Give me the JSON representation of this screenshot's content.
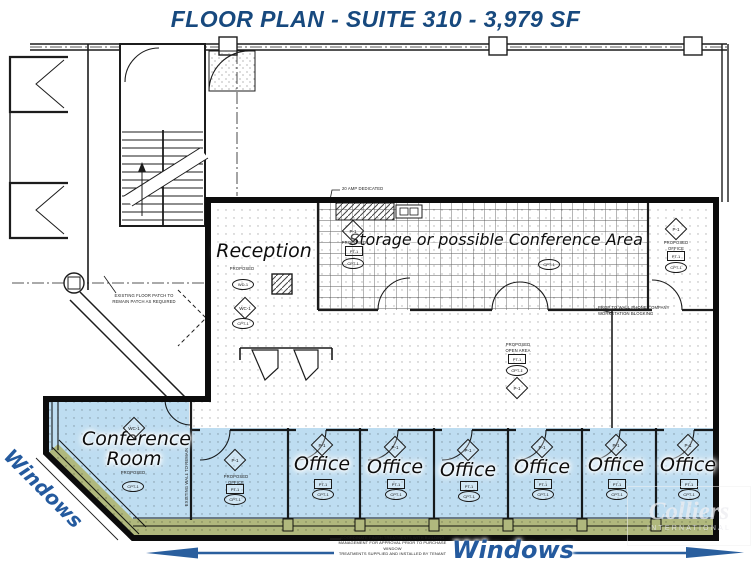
{
  "title": "FLOOR PLAN - SUITE 310 - 3,979 SF",
  "rooms": {
    "reception": "Reception",
    "storage": "Storage or possible Conference Area",
    "conference": "Conference Room",
    "offices": [
      "Office",
      "Office",
      "Office",
      "Office",
      "Office",
      "Office"
    ]
  },
  "window_labels": {
    "left": "Windows",
    "bottom": "Windows"
  },
  "tags": {
    "p1": "P-1",
    "wc1": "WC-1",
    "cpt1": "CPT-1",
    "pt1": "PT-1",
    "wd1": "WD-1"
  },
  "notes": {
    "dedicated": "20 AMP DEDICATED",
    "floor_patch": "EXISTING FLOOR PATCH TO\nREMAIN PATCH AS REQUIRED",
    "phone": "PROP TO WALL PHONE COMPANY\nWORKSTATION BLOCKING",
    "open_area": "PROPOSED\nOPEN AREA",
    "proposed_office": "PROPOSED\nOFFICE",
    "proposed": "PROPOSED",
    "window_treatment": "COORDINATE FINISH TREATMENTS WITH BUILDING\nMANAGEMENT FOR APPROVAL PRIOR TO PURCHASE WINDOW\nTREATMENTS SUPPLIED AND INSTALLED BY TENANT",
    "existing_wall": "EXISTING WALL TO REMAIN"
  },
  "watermark": {
    "line1": "Colliers",
    "line2": "INTERNATIONAL"
  },
  "colors": {
    "title_blue": "#17497e",
    "windows_text_blue": "#245a9e",
    "highlight_blue": "#b3d7ef",
    "highlight_yellow": "#ecd584",
    "line_black": "#1c1c1c"
  }
}
